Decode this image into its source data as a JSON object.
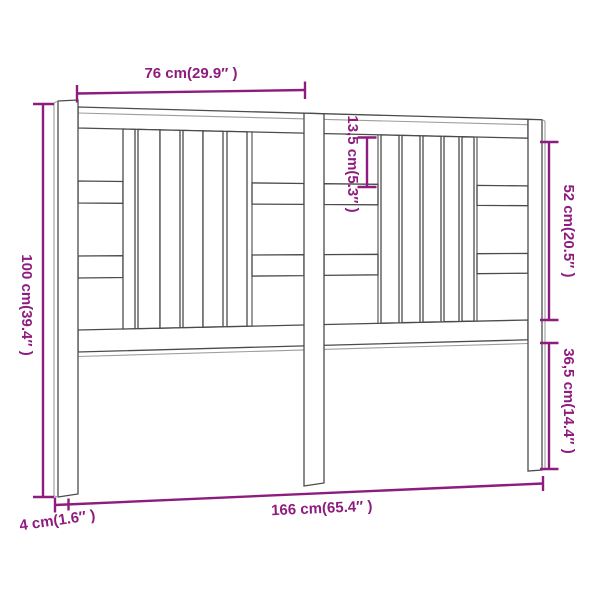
{
  "diagram": {
    "type": "product dimension line drawing",
    "subject": "wooden slatted bed headboard, three-quarter perspective view",
    "colors": {
      "background": "#ffffff",
      "outline": "#4b4b4b",
      "dimension_accent": "#8e1c7e"
    },
    "dimensions": {
      "top_width": "76 cm(29.9″ )",
      "height": "100 cm(39.4″ )",
      "slat_opening": "13,5 cm(5.3″ )",
      "upper_section_height": "52 cm(20.5″ )",
      "leg_height": "36,5 cm(14.4″ )",
      "total_width": "166 cm(65.4″ )",
      "depth": "4 cm(1.6″ )"
    }
  }
}
